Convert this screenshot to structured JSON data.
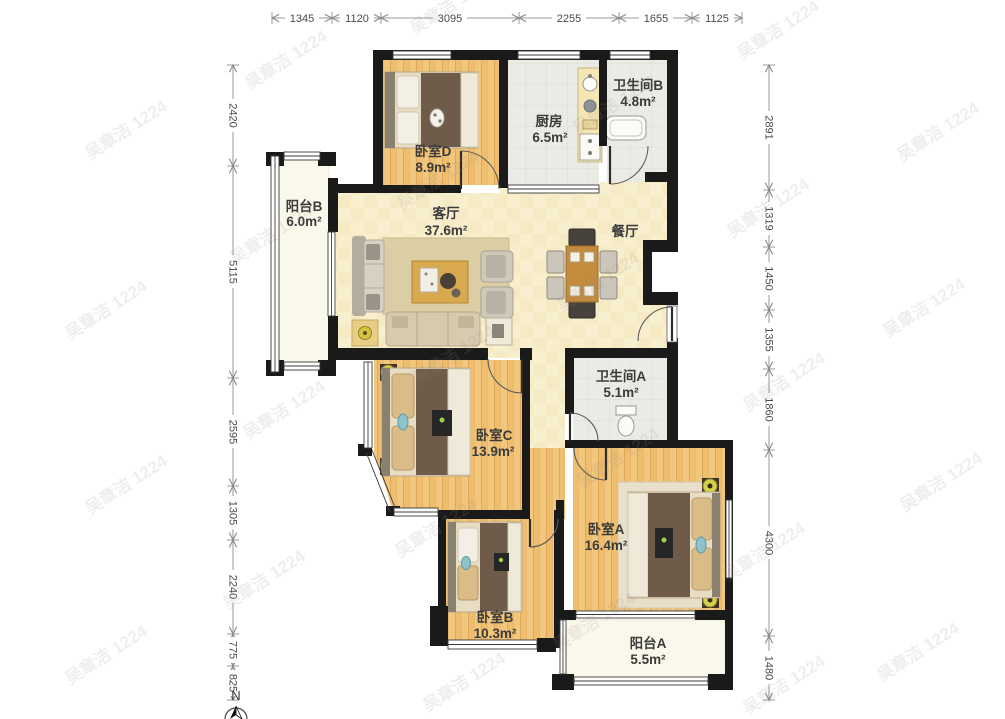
{
  "watermark": {
    "text": "吴章洁 1224"
  },
  "compass": {
    "label": "N"
  },
  "dimensions": {
    "top": [
      "1345",
      "1120",
      "3095",
      "2255",
      "1655",
      "1125"
    ],
    "left": [
      "2420",
      "5115",
      "2595",
      "1305",
      "2240",
      "775",
      "825"
    ],
    "right": [
      "2891",
      "1319",
      "1450",
      "1355",
      "1860",
      "4300",
      "1480"
    ]
  },
  "rooms": {
    "bedroom_d": {
      "name": "卧室D",
      "area": "8.9m²"
    },
    "kitchen": {
      "name": "厨房",
      "area": "6.5m²"
    },
    "bathroom_b": {
      "name": "卫生间B",
      "area": "4.8m²"
    },
    "balcony_b": {
      "name": "阳台B",
      "area": "6.0m²"
    },
    "living_room": {
      "name": "客厅",
      "area": "37.6m²"
    },
    "dining_room": {
      "name": "餐厅"
    },
    "bathroom_a": {
      "name": "卫生间A",
      "area": "5.1m²"
    },
    "bedroom_c": {
      "name": "卧室C",
      "area": "13.9m²"
    },
    "bedroom_a": {
      "name": "卧室A",
      "area": "16.4m²"
    },
    "bedroom_b": {
      "name": "卧室B",
      "area": "10.3m²"
    },
    "balcony_a": {
      "name": "阳台A",
      "area": "5.5m²"
    }
  },
  "colors": {
    "wall": "#1a1a1a",
    "wood_floor": "#f1c67d",
    "tile_floor": "#ebebe6",
    "living_floor": "#f8efcf",
    "balcony_floor": "#faf8ea",
    "bed_blanket": "#6e5b49",
    "accent_teal": "#8fc3cc",
    "lamp_yellow": "#d6d14b"
  }
}
